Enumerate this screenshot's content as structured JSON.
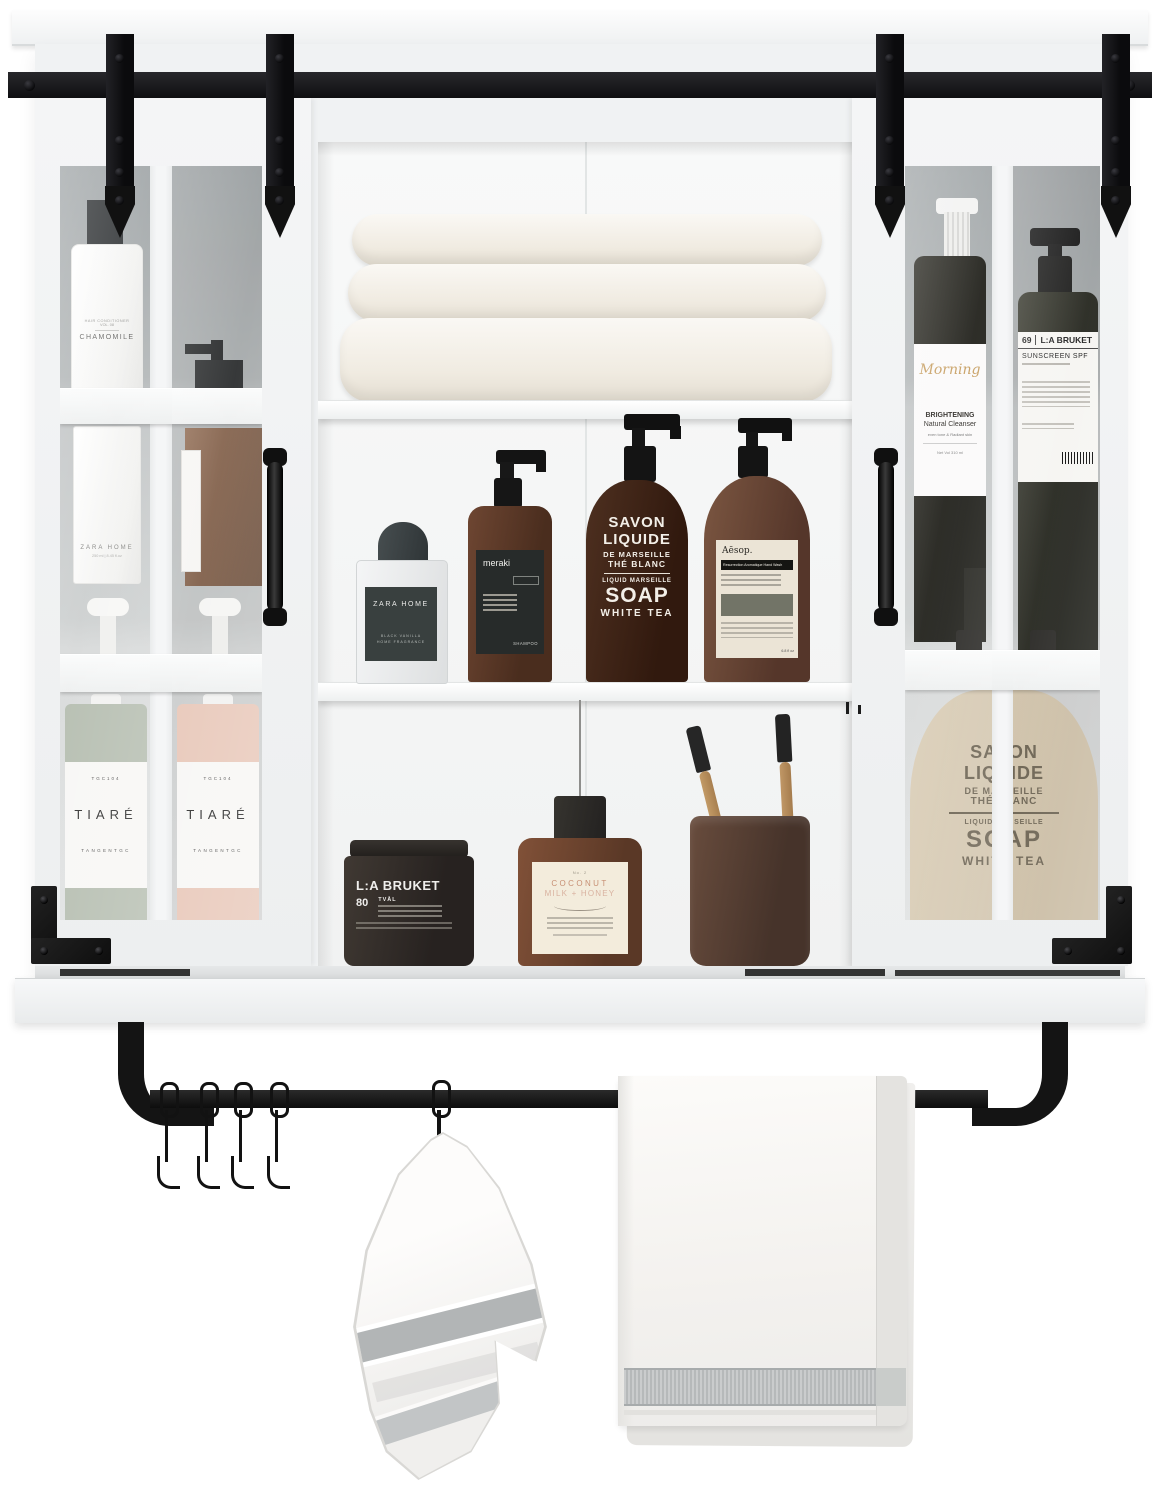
{
  "cabinet": {
    "left_door": {
      "conditioner": {
        "line1": "HAIR CONDITIONER",
        "line2": "VOL. 08",
        "name": "CHAMOMILE"
      },
      "zara_bottle": {
        "brand": "ZARA HOME",
        "size": "250 ml | 8.45 fl.oz"
      },
      "tiare_a": {
        "code": "TGC104",
        "name": "TIARÉ",
        "brand": "TANGENTGC"
      },
      "tiare_b": {
        "code": "TGC104",
        "name": "TIARÉ",
        "brand": "TANGENTGC"
      }
    },
    "shelf_middle": {
      "fragrance": {
        "brand": "ZARA HOME",
        "line1": "BLACK VANILLA",
        "line2": "HOME FRAGRANCE"
      },
      "shampoo": {
        "brand": "meraki",
        "type": "SHAMPOO"
      },
      "soap": {
        "l1": "SAVON",
        "l2": "LIQUIDE",
        "l3": "DE MARSEILLE",
        "l4": "THÉ BLANC",
        "l5": "LIQUID MARSEILLE",
        "l6": "SOAP",
        "l7": "WHITE TEA"
      },
      "handwash": {
        "brand": "Aēsop.",
        "title": "Resurrection Aromatique Hand Wash",
        "size": "6.8 fl oz"
      }
    },
    "shelf_bottom": {
      "jar": {
        "brand": "L:A BRUKET",
        "num": "80",
        "type": "TVÅL"
      },
      "bodywash": {
        "num": "No. 2",
        "l1": "COCONUT",
        "l2": "MILK + HONEY"
      }
    },
    "right_door": {
      "cleanser": {
        "script": "Morning",
        "l1": "BRIGHTENING",
        "l2": "Natural Cleanser",
        "l3": "even tone & Radiant skin",
        "l4": "Net Vol 310 ml"
      },
      "sunscreen": {
        "num": "69",
        "brand": "L:A BRUKET",
        "type": "SUNSCREEN SPF"
      },
      "soap_big": {
        "l1": "SAVON",
        "l2": "LIQUIDE",
        "l3": "DE MARSEILLE",
        "l4": "THÉ BLANC",
        "l5": "LIQUID MARSEILLE",
        "l6": "SOAP",
        "l7": "WHITE TEA"
      }
    }
  },
  "colors": {
    "hardware": "#141414",
    "cabinet_white": "#f0f2f3",
    "amber": "#4a2d1e",
    "cream_label": "#ece5d6",
    "sage": "#b7bfb2",
    "blush": "#e9cabc",
    "towel_band": "#b6b9ba"
  }
}
